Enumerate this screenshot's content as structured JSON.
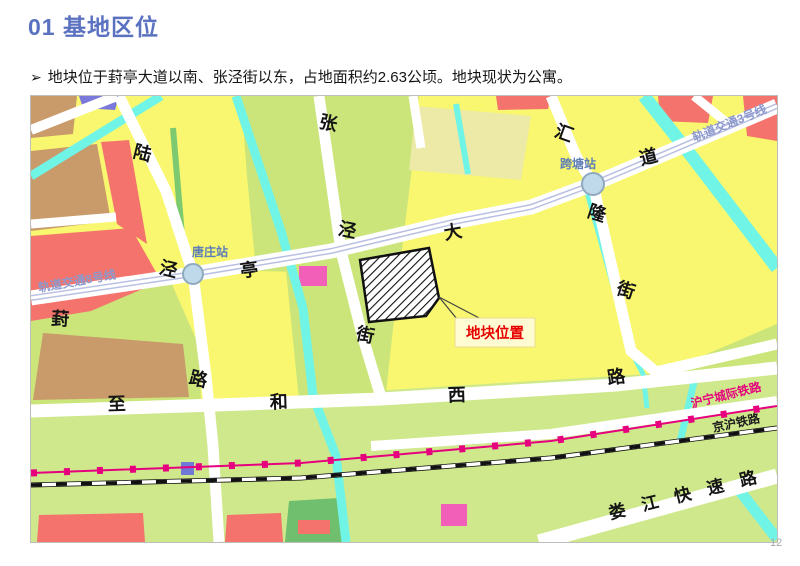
{
  "slide": {
    "title": "01 基地区位",
    "bullet_marker": "➢",
    "bullet": "地块位于葑亭大道以南、张泾街以东，占地面积约2.63公顷。地块现状为公寓。",
    "page_number": "12"
  },
  "map": {
    "site_callout": {
      "label": "地块位置"
    },
    "stations": [
      {
        "name": "唐庄站"
      },
      {
        "name": "跨塘站"
      }
    ],
    "rail_lines": [
      {
        "name": "轨道交通8号线"
      },
      {
        "name": "轨道交通3号线"
      },
      {
        "name": "沪宁城际铁路"
      },
      {
        "name": "京沪铁路"
      }
    ],
    "streets": {
      "lujing": [
        "陆",
        "泾",
        "路"
      ],
      "zhangjing": [
        "张",
        "泾",
        "街"
      ],
      "huilong": [
        "汇",
        "隆",
        "街"
      ],
      "fengting": [
        "葑",
        "亭",
        "大",
        "道"
      ],
      "zhihexi": [
        "至",
        "和",
        "西",
        "路"
      ],
      "loujiang": "娄 江 快 速 路"
    },
    "colors": {
      "title_blue": "#5B72C0",
      "parcel_yellow": "#F8F76F",
      "parcel_yellow_green": "#CBE57A",
      "parcel_light_green": "#CFE88C",
      "parcel_tan": "#C99A6A",
      "parcel_red": "#F4736C",
      "parcel_pink": "#F15FB8",
      "parcel_purple": "#7B78DC",
      "canal_cyan": "#70F4E6",
      "metro_line": "#B9C0E1",
      "intercity_rail_magenta": "#E6007E",
      "site_label_red": "#E60000",
      "station_fill": "#BFD8EA"
    }
  }
}
